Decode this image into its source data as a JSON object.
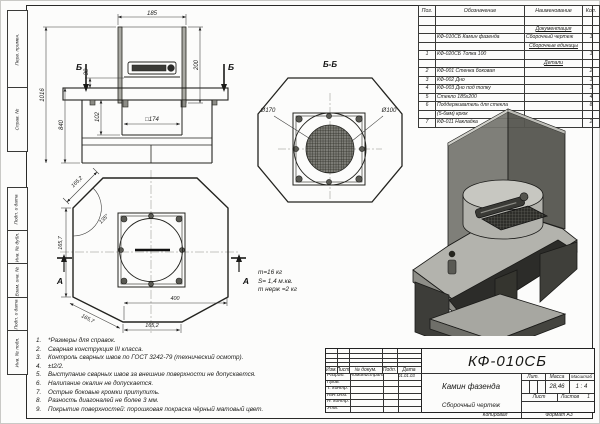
{
  "page": {
    "side_labels": [
      "Перв. примен.",
      "Справ. №",
      "Подп. и дата",
      "Инв. № дубл.",
      "Взам. инв. №",
      "Подп. и дата",
      "Инв. № подл."
    ],
    "copied_label": "Копировал",
    "format_label": "Формат А3"
  },
  "parts_table": {
    "headers": [
      "Поз.",
      "Обозначение",
      "Наименование",
      "Кол."
    ],
    "rows": [
      [
        "",
        "",
        "",
        ""
      ],
      [
        "",
        "",
        "Документация",
        ""
      ],
      [
        "",
        "КФ-010СБ Камин фазенда",
        "Сборочный чертеж",
        "1"
      ],
      [
        "",
        "",
        "Сборочные единицы",
        ""
      ],
      [
        "1",
        "КФ-020СБ Топка 100",
        "",
        "1"
      ],
      [
        "",
        "",
        "Детали",
        ""
      ],
      [
        "2",
        "КФ-001 Стенка боковая",
        "",
        "2"
      ],
      [
        "3",
        "КФ-002 Дно",
        "",
        "1"
      ],
      [
        "4",
        "КФ-003 Дно под топку",
        "",
        "1"
      ],
      [
        "5",
        "Стекло 185х200",
        "",
        "4"
      ],
      [
        "6",
        "Поддерживатель для стекла",
        "",
        "8"
      ],
      [
        "",
        "(5-6мм) крюк",
        "",
        ""
      ],
      [
        "7",
        "КФ-011 Накладка",
        "",
        "2"
      ]
    ]
  },
  "front_view": {
    "dim_185": "185",
    "dim_200": "200",
    "dim_1016": "1016",
    "dim_840": "840",
    "dim_30": "30",
    "dim_102": "102",
    "dim_square": "□174",
    "section_label": "Б"
  },
  "section_view": {
    "title": "Б-Б",
    "dim_d170": "Ø170",
    "dim_d100": "Ø100"
  },
  "top_view": {
    "dim_top_slant": "165,2",
    "dim_angle": "135°",
    "dim_left": "165,7",
    "dim_bottom_slant": "165,7",
    "dim_width": "400",
    "dim_bottom": "165,2",
    "section_label": "А"
  },
  "mass_note": [
    "m=16 кг",
    "S= 1,4 м.кв.",
    "m нерж =2 кг"
  ],
  "notes": [
    "*Размеры для справок.",
    "Сварная конструкция III класса.",
    "Контроль сварных швов по ГОСТ 3242-79 (технический осмотр).",
    "±t2/2.",
    "Выступание сварных швов за внешние поверхности не допускается.",
    "Налипание окалин не допускается.",
    "Острые боковые кромки притупить.",
    "Разность диагоналей не более 3 мм.",
    "Покрытие поверхностей: порошковая покраска чёрный матовый цвет."
  ],
  "title_block": {
    "doc_number": "КФ-010СБ",
    "product_name": "Камин фазенда",
    "doc_type": "Сборочный чертеж",
    "header_cells": [
      "Изм.",
      "Лист",
      "№ докум.",
      "Подп.",
      "Дата"
    ],
    "sig_rows": [
      {
        "role": "Разраб.",
        "name": "Администратор",
        "date": "01.01.03"
      },
      {
        "role": "Пров.",
        "name": "",
        "date": ""
      },
      {
        "role": "Т. контр.",
        "name": "",
        "date": ""
      },
      {
        "role": "Нач.отд.",
        "name": "",
        "date": ""
      },
      {
        "role": "Н. контр.",
        "name": "",
        "date": ""
      },
      {
        "role": "Утв.",
        "name": "",
        "date": ""
      }
    ],
    "lit_label": "Лит.",
    "mass_label": "Масса",
    "scale_label": "Масштаб",
    "mass_value": "28,46",
    "scale_value": "1 : 4",
    "sheet_label": "Лист",
    "sheets_label": "Листов",
    "sheets_value": "1"
  },
  "colors": {
    "paper": "#fcfcfb",
    "line": "#2a2a28",
    "metal_top": "#b3b3ad",
    "metal_side": "#8e8e88",
    "metal_dark": "#3d3d39"
  }
}
